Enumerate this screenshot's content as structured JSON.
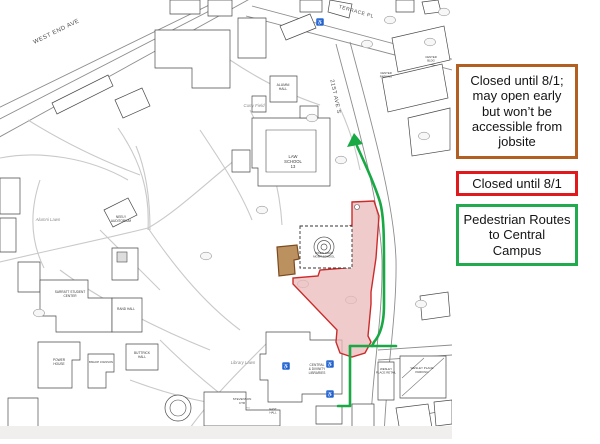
{
  "title": "Campus closure and pedestrian route map",
  "colors": {
    "closed_area_border": "#cc2b2b",
    "closed_area_fill": "#eab9b9",
    "jobsite_fill": "#b5854f",
    "jobsite_border": "#7c4a1e",
    "route_green": "#18a945",
    "accessibility_blue": "#2e6fd0",
    "legend_brown_border": "#b35f22",
    "legend_red_border": "#e0191d",
    "legend_green_border": "#22aa4e"
  },
  "icons": {
    "accessibility": "♿"
  },
  "legend": {
    "boxes": [
      {
        "name": "closed-jobsite",
        "text": "Closed until 8/1;\nmay open early\nbut won’t be\naccessible from\njobsite"
      },
      {
        "name": "closed",
        "text": "Closed until 8/1"
      },
      {
        "name": "pedestrian-routes",
        "text": "Pedestrian Routes\nto Central\nCampus"
      }
    ]
  },
  "map": {
    "street_labels": [
      {
        "text": "WEST END AVE",
        "x": 57,
        "y": 33,
        "r": -26,
        "s": 6
      },
      {
        "text": "TERRACE PL",
        "x": 356,
        "y": 13,
        "r": 16,
        "s": 5
      },
      {
        "text": "21ST AVE S",
        "x": 334,
        "y": 97,
        "r": 78,
        "s": 5.5
      }
    ],
    "lawn_labels": [
      {
        "text": "Alumni Lawn",
        "x": 48,
        "y": 221
      },
      {
        "text": "Library Lawn",
        "x": 243,
        "y": 364
      },
      {
        "text": "Curry Field",
        "x": 254,
        "y": 107
      }
    ],
    "building_labels": [
      {
        "lines": [
          "LAW",
          "SCHOOL",
          "13"
        ],
        "x": 293,
        "y": 158,
        "s": 4.2
      },
      {
        "lines": [
          "ALUMNI",
          "HALL"
        ],
        "x": 283,
        "y": 86,
        "s": 3.4
      },
      {
        "lines": [
          "NEELY",
          "AUDITORIUM"
        ],
        "x": 121,
        "y": 218,
        "s": 3.2
      },
      {
        "lines": [
          "SARRATT STUDENT",
          "CENTER"
        ],
        "x": 70,
        "y": 293,
        "s": 3.2
      },
      {
        "lines": [
          "RAND HALL"
        ],
        "x": 126,
        "y": 310,
        "s": 3.2
      },
      {
        "lines": [
          "BUTTRICK",
          "HALL"
        ],
        "x": 142,
        "y": 354,
        "s": 3.2
      },
      {
        "lines": [
          "CENTRAL",
          "& DIVINITY",
          "LIBRARIES"
        ],
        "x": 317,
        "y": 366,
        "s": 3.2
      },
      {
        "lines": [
          "WESLEY",
          "PLACE RETAIL"
        ],
        "x": 386,
        "y": 370,
        "s": 2.9
      },
      {
        "lines": [
          "WESLEY PLACE",
          "PARKING"
        ],
        "x": 422,
        "y": 369,
        "s": 3
      },
      {
        "lines": [
          "POWER",
          "HOUSE"
        ],
        "x": 59,
        "y": 361,
        "s": 3.2
      },
      {
        "lines": [
          "BISHOP JOHNSON"
        ],
        "x": 101,
        "y": 363,
        "s": 2.7
      },
      {
        "lines": [
          "STEVENSON",
          "CTR"
        ],
        "x": 242,
        "y": 400,
        "s": 3
      },
      {
        "lines": [
          "OWEN GRAD",
          "MGMT SCHOOL"
        ],
        "x": 324,
        "y": 254,
        "s": 2.9
      },
      {
        "lines": [
          "CENTER",
          "BLDG"
        ],
        "x": 431,
        "y": 58,
        "s": 2.8
      },
      {
        "lines": [
          "CENTER",
          "PARKING"
        ],
        "x": 386,
        "y": 74,
        "s": 2.8
      },
      {
        "lines": [
          "EAST",
          "HALL"
        ],
        "x": 273,
        "y": 410,
        "s": 2.8
      }
    ]
  }
}
